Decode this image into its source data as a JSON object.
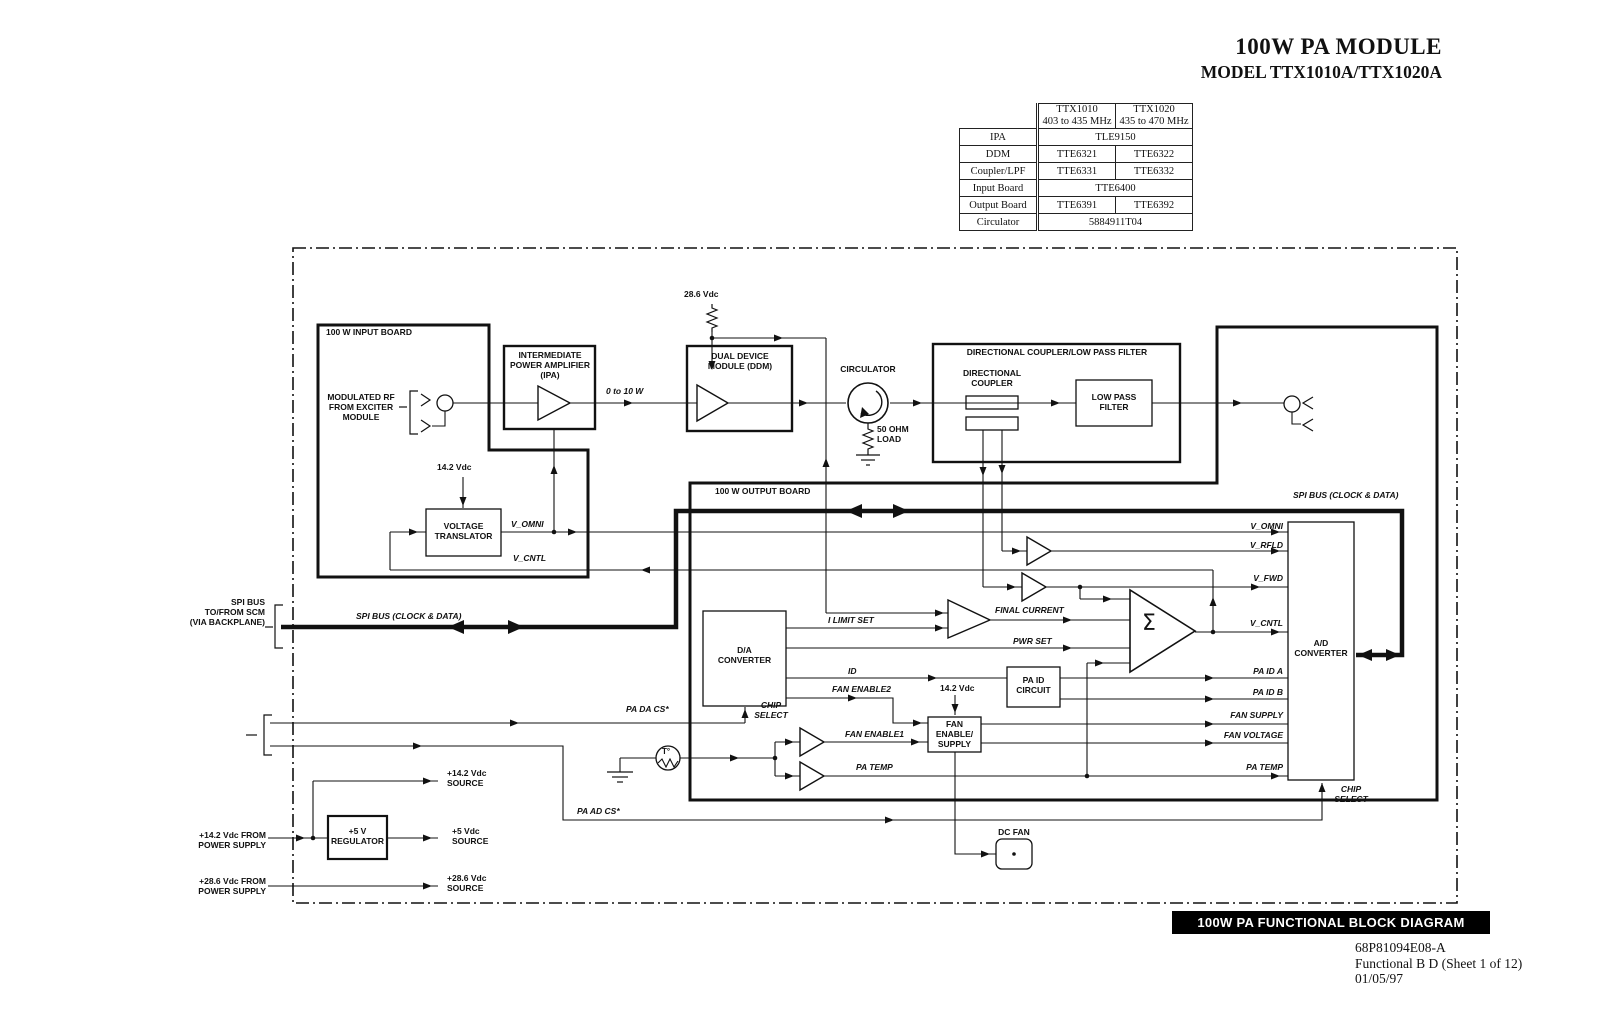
{
  "header": {
    "title": "100W PA MODULE",
    "subtitle": "MODEL TTX1010A/TTX1020A"
  },
  "parts_table": {
    "col_headers": [
      {
        "model": "TTX1010",
        "range": "403 to 435 MHz"
      },
      {
        "model": "TTX1020",
        "range": "435 to 470 MHz"
      }
    ],
    "rows": [
      {
        "label": "IPA",
        "span": "TLE9150"
      },
      {
        "label": "DDM",
        "v1": "TTE6321",
        "v2": "TTE6322"
      },
      {
        "label": "Coupler/LPF",
        "v1": "TTE6331",
        "v2": "TTE6332"
      },
      {
        "label": "Input Board",
        "span": "TTE6400"
      },
      {
        "label": "Output Board",
        "v1": "TTE6391",
        "v2": "TTE6392"
      },
      {
        "label": "Circulator",
        "span": "5884911T04"
      }
    ]
  },
  "diagram": {
    "input_board": "100 W INPUT BOARD",
    "output_board": "100 W OUTPUT BOARD",
    "modulated_rf": "MODULATED RF\nFROM EXCITER\nMODULE",
    "ipa": "INTERMEDIATE\nPOWER AMPLIFIER\n(IPA)",
    "pwr_0_10": "0 to 10 W",
    "v28_6": "28.6 Vdc",
    "ddm": "DUAL DEVICE\nMODULE (DDM)",
    "circulator": "CIRCULATOR",
    "load_50ohm": "50 OHM\nLOAD",
    "dclpf": "DIRECTIONAL COUPLER/LOW PASS FILTER",
    "dir_coupler": "DIRECTIONAL\nCOUPLER",
    "lpf": "LOW PASS\nFILTER",
    "v14_2": "14.2 Vdc",
    "translator": "VOLTAGE\nTRANSLATOR",
    "v_omni_left": "V_OMNI",
    "v_cntl_left": "V_CNTL",
    "spi_top": "SPI BUS (CLOCK & DATA)",
    "spi_mid": "SPI BUS (CLOCK & DATA)",
    "spi_left": "SPI BUS\nTO/FROM SCM\n(VIA BACKPLANE)",
    "da": "D/A\nCONVERTER",
    "ad": "A/D\nCONVERTER",
    "i_limit_set": "I LIMIT SET",
    "final_current": "FINAL CURRENT",
    "pwr_set": "PWR SET",
    "id": "ID",
    "fan_enable2": "FAN ENABLE2",
    "v14_2_fan": "14.2 Vdc",
    "pa_id_circuit": "PA ID\nCIRCUIT",
    "fan_enable_supply": "FAN\nENABLE/\nSUPPLY",
    "fan_enable1": "FAN ENABLE1",
    "pa_temp_left": "PA TEMP",
    "chip_select_da": "CHIP\nSELECT",
    "chip_select_ad": "CHIP\nSELECT",
    "pa_da_cs": "PA DA CS*",
    "pa_ad_cs": "PA AD CS*",
    "v_omni_right": "V_OMNI",
    "v_rfld": "V_RFLD",
    "v_fwd": "V_FWD",
    "v_cntl_right": "V_CNTL",
    "pa_id_a": "PA ID A",
    "pa_id_b": "PA ID B",
    "fan_supply": "FAN SUPPLY",
    "fan_voltage": "FAN VOLTAGE",
    "pa_temp_right": "PA TEMP",
    "dc_fan": "DC FAN",
    "t_sensor": "T°",
    "sigma": "Σ",
    "src_14_2": "+14.2 Vdc\nSOURCE",
    "src_5": "+5 Vdc\nSOURCE",
    "src_28_6": "+28.6 Vdc\nSOURCE",
    "from_14_2": "+14.2 Vdc FROM\nPOWER SUPPLY",
    "from_28_6": "+28.6 Vdc FROM\nPOWER SUPPLY",
    "regulator": "+5 V\nREGULATOR"
  },
  "footer": {
    "banner": "100W PA FUNCTIONAL BLOCK DIAGRAM",
    "doc_number": "68P81094E08-A",
    "sheet": "Functional B D (Sheet 1 of 12)",
    "date": "01/05/97"
  },
  "colors": {
    "line": "#111111",
    "banner_bg": "#000000",
    "banner_fg": "#ffffff"
  }
}
